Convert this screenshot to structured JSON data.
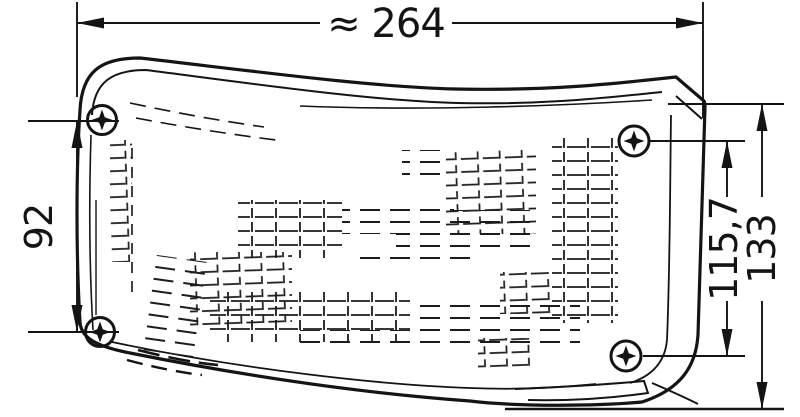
{
  "drawing": {
    "background_color": "#ffffff",
    "line_color": "#141414",
    "dimensions": {
      "overall_width": {
        "label": "≈ 264"
      },
      "left_mount_spacing": {
        "label": "92"
      },
      "right_mount_spacing": {
        "label": "115,7"
      },
      "overall_height": {
        "label": "133"
      }
    },
    "screws": [
      {
        "position": "top-left"
      },
      {
        "position": "top-right"
      },
      {
        "position": "bottom-right"
      },
      {
        "position": "bottom-left"
      }
    ],
    "icons": {
      "screw": "phillips-screw-icon"
    }
  }
}
